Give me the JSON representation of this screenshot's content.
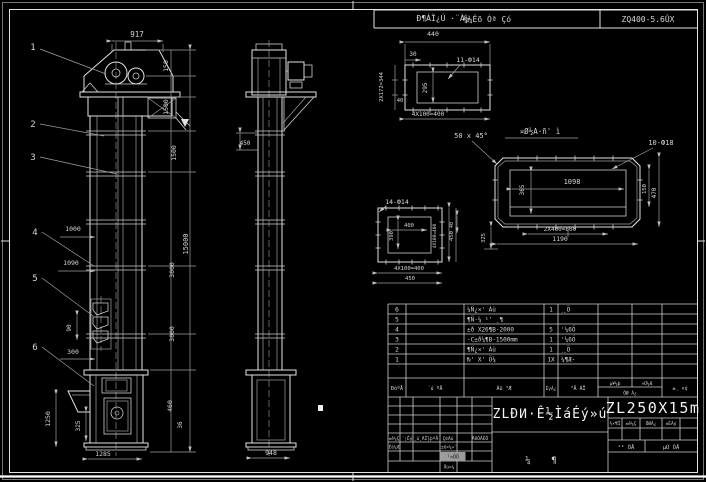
{
  "top_header": {
    "tech_note": "¼¼Êõ Òª Çó",
    "spec": "ZQ400-5.6ÛX"
  },
  "front_view": {
    "balloons": [
      "1",
      "2",
      "3",
      "4",
      "5",
      "6"
    ],
    "dims": {
      "w917": "917",
      "h150": "150",
      "h1500a": "1500",
      "h1500b": "1500",
      "s3000a": "3000",
      "s3000b": "3000",
      "total": "15000",
      "d1000": "1000",
      "d1090": "1090",
      "d90": "90",
      "d300": "300",
      "d1250": "1250",
      "d325": "325",
      "d1285": "1285",
      "d460": "460",
      "d36": "36"
    }
  },
  "side_view": {
    "dims": {
      "d450": "450",
      "d948": "948"
    }
  },
  "flange_detail": {
    "title": "Ð¶ÁÏ¿Ú ·¨À¼",
    "d440": "440",
    "d30": "30",
    "holes": "11-Ф14",
    "d295": "295",
    "pitch_left": "2X172=344",
    "d40": "40",
    "pitch_bottom": "4X100=400"
  },
  "casing_detail": {
    "label": "¤Ø½A·ñ' ì",
    "chamfer": "50 x 45°",
    "holes": "10-Ф18",
    "d1098": "1098",
    "d365": "365",
    "d150": "150",
    "d470": "470",
    "pitch": "2X400=800",
    "d1190": "1190",
    "d40": "40",
    "d325": "325"
  },
  "square_detail": {
    "holes": "14-Ф14",
    "d400": "400",
    "d390": "390",
    "pitch_right": "4X100=400",
    "d450r": "450",
    "pitch_bottom": "4X100=400",
    "d450b": "450"
  },
  "bom": {
    "headers": {
      "seq": "ÐòºÅ",
      "code": "´ú ºÅ",
      "name": "Ãû ³Æ",
      "qty": "ÊýÁ¿",
      "material": "²Ä ÁÏ",
      "unit": "µ¥¼þ",
      "total": "×Ü¼Æ",
      "weight": "ÖØ Á¿",
      "remark": "±¸ ×¢"
    },
    "rows": [
      {
        "seq": "6",
        "code": "",
        "name": "¼Ñ¿×' Áù",
        "qty": "1",
        "material": "˼¸Ö",
        "remark": ""
      },
      {
        "seq": "5",
        "code": "",
        "name": "¶Ñ·¼ ¹' ¸¶",
        "qty": "",
        "material": "",
        "remark": ""
      },
      {
        "seq": "4",
        "code": "",
        "name": "±ð X26¶B-2000",
        "qty": "5",
        "material": "'¼6Ö",
        "remark": ""
      },
      {
        "seq": "3",
        "code": "",
        "name": "·C±ð¼¶B-1500mm",
        "qty": "1",
        "material": "'¼6Ö",
        "remark": ""
      },
      {
        "seq": "2",
        "code": "",
        "name": "¶Ñ¿×' Áù",
        "qty": "1",
        "material": "˼¸Ö",
        "remark": ""
      },
      {
        "seq": "1",
        "code": "",
        "name": "Ƕ' X' Ö¼",
        "qty": "1X",
        "material": "¼¶Æ·",
        "remark": ""
      }
    ]
  },
  "title_block": {
    "main_title": "ZLÐͶ·Ê½ÌáÉý»ú",
    "model": "ZL250X15m",
    "sub_left": "¼",
    "sub_right": "¶",
    "sig": {
      "mark": "±ê¼Ç",
      "count": "´¦Êý",
      "file": "¸ü¸ÄÎļþºÅ",
      "sign": "Ç©Ãû",
      "date": "ÄêÔÂÈÕ",
      "design": "Éè¼Æ",
      "standard": "±ê×¼»¯",
      "process": "¹¤ÒÕ",
      "approve": "Åú×¼"
    },
    "stage": {
      "c1": "½×¶Î",
      "c2": "±ê¼Ç",
      "c3": "ÖØÁ¿",
      "c4": "±ÈÀý"
    },
    "sheets": {
      "total": "¹² ÕÅ",
      "no": "µÚ ÕÅ"
    }
  }
}
